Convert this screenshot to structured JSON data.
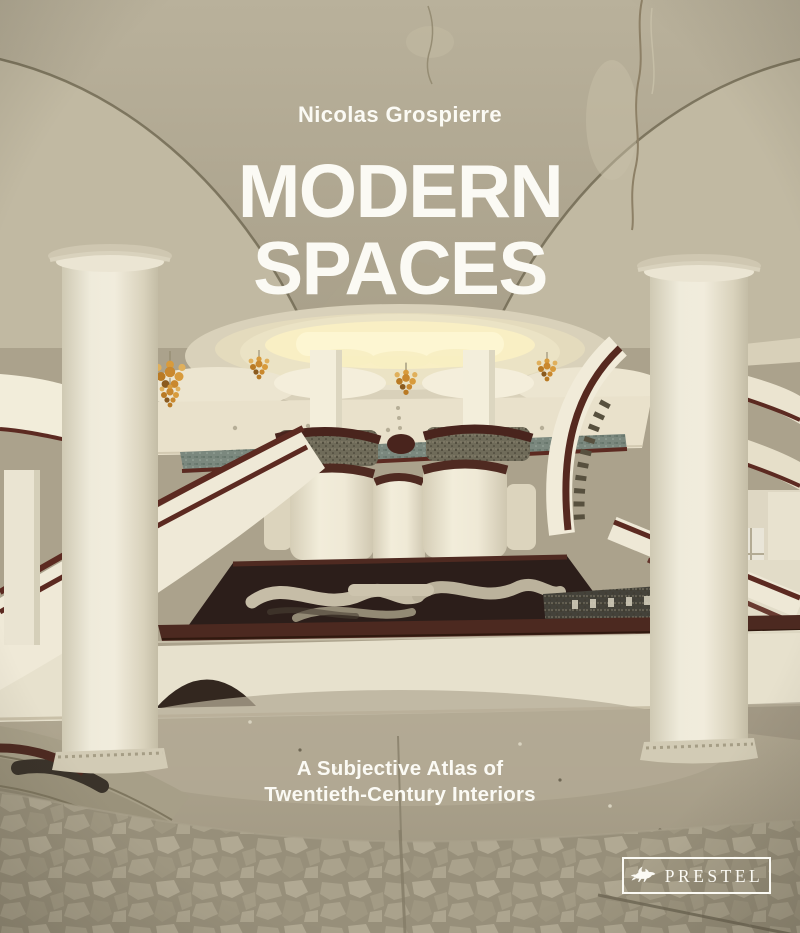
{
  "cover": {
    "author": "Nicolas Grospierre",
    "title_line1": "MODERN",
    "title_line2": "SPACES",
    "subtitle_line1": "A Subjective Atlas of",
    "subtitle_line2": "Twentieth-Century Interiors",
    "publisher": "PRESTEL"
  },
  "palette": {
    "text": "#fbfaf4",
    "maroon": "#5c2a21",
    "amber": "#c9882e",
    "ceiling": "#b2aa93",
    "cream": "#efe9d6",
    "teal": "#7b887e",
    "floor": "#a39a85",
    "glow": "#fdf6d2",
    "void": "#2c1e1a"
  }
}
